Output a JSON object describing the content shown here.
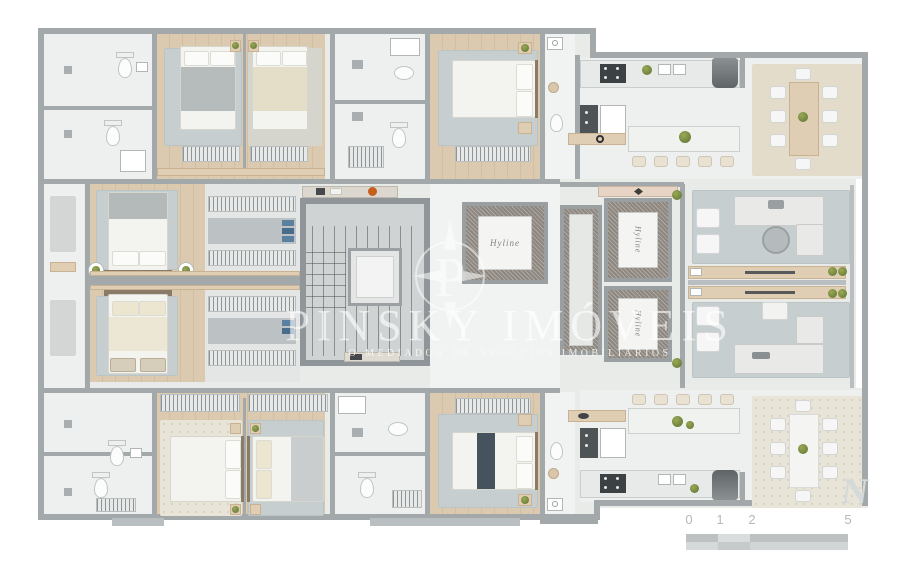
{
  "watermark": {
    "logo_letter": "P",
    "brand": "PINSKY IMÓVEIS",
    "tagline": "O MEDIADOR DE NEGÓCIOS IMOBILIÁRIOS"
  },
  "elevator_panel_script": "Hyline",
  "north_mark": "N",
  "scale_bar": {
    "ticks": [
      "0",
      "1",
      "2",
      "5"
    ]
  },
  "palette": {
    "background": "#ffffff",
    "floor": "#eaecea",
    "wall": "#a3a9ab",
    "wood": "#d9c7ae",
    "rug_gray": "#c7ced0",
    "rug_beige": "#e3dccb",
    "marble": "#8d8780",
    "plant_green": "#6f8a3c",
    "accent_orange": "#c65f1e",
    "scale_text": "#b4b8ba"
  }
}
